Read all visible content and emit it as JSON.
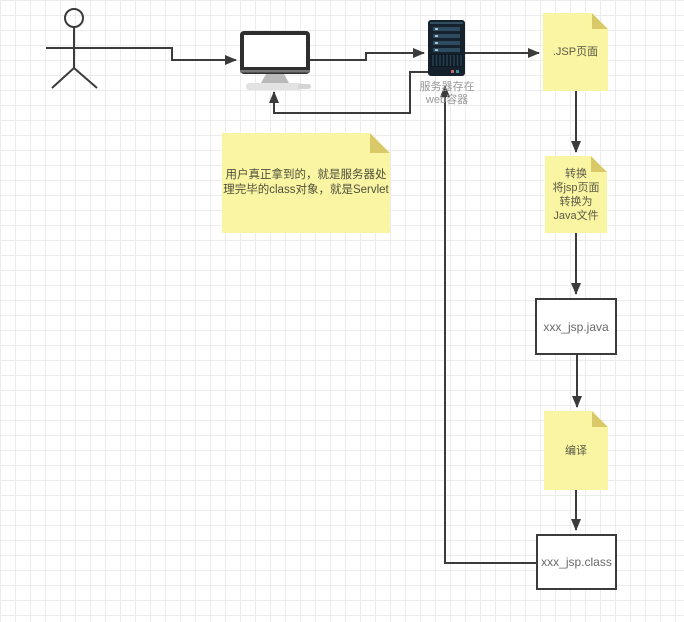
{
  "diagram": {
    "server_label": {
      "line1": "服务器存在",
      "line2": "web容器"
    },
    "notes": {
      "jsp": {
        "label": ".JSP页面"
      },
      "convert": {
        "line1": "转换",
        "line2": "将jsp页面",
        "line3": "转换为",
        "line4": "Java文件"
      },
      "compile": {
        "label": "编译"
      },
      "explain": {
        "line1": "用户真正拿到的，就是服务器处",
        "line2": "理完毕的class对象，就是Servlet"
      }
    },
    "boxes": {
      "java_file": {
        "label": "xxx_jsp.java"
      },
      "class_file": {
        "label": "xxx_jsp.class"
      }
    },
    "colors": {
      "connector": "#3b3b3b",
      "note_fill": "#faf5a3",
      "note_fold": "#d9c968",
      "note_text": "#5a5a45",
      "box_border": "#3b3b3b",
      "box_fill": "#ffffff",
      "box_text": "#696969",
      "server_body": "#15222e",
      "server_slot": "#2d4c60",
      "server_label_text": "#999999",
      "grid_line": "#ececec",
      "canvas_bg": "#ffffff"
    }
  }
}
